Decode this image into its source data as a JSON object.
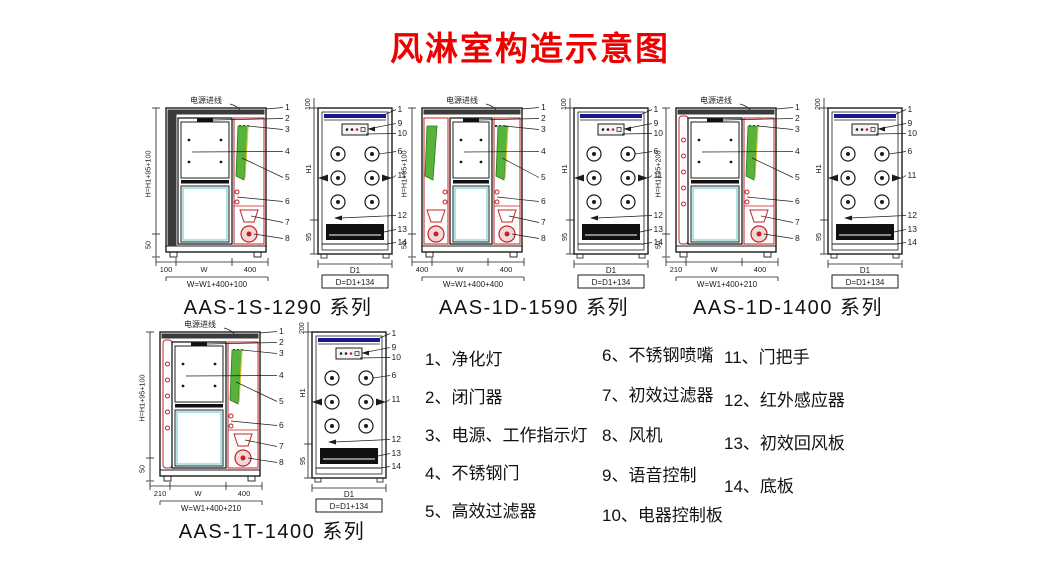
{
  "title": "风淋室构造示意图",
  "colors": {
    "title": "#ee0000",
    "line": "#1c1c1c",
    "red": "#c42222",
    "green": "#57b33a",
    "green_dark": "#2c7a1d",
    "blue": "#181890",
    "cyan": "#5fc8c8",
    "yellow": "#d9c23a",
    "dark_fill": "#3a3a3a",
    "black_fill": "#111111",
    "pink": "#f3d8d8"
  },
  "diagrams": [
    {
      "id": "aas-1s-1290",
      "series_label": "AAS-1S-1290 系列",
      "style": "single",
      "top_label": "电源进线",
      "side": {
        "height_formula": "H=H1+95+100",
        "base_height": "50",
        "bottom_dims": [
          "100",
          "W",
          "400"
        ],
        "width_formula": "W=W1+400+100",
        "callouts": [
          "1",
          "2",
          "3",
          "4",
          "5",
          "6",
          "7",
          "8"
        ]
      },
      "front": {
        "top_dim": "100",
        "height_dim": "H1",
        "bottom_section_dim": "95",
        "depth_dim": "D1",
        "depth_formula": "D=D1+134",
        "callouts": [
          "1",
          "9",
          "10",
          "6",
          "11",
          "12",
          "13",
          "14"
        ]
      }
    },
    {
      "id": "aas-1d-1590",
      "series_label": "AAS-1D-1590 系列",
      "style": "double",
      "top_label": "电源进线",
      "side": {
        "height_formula": "H=H1+95+100",
        "base_height": "50",
        "bottom_dims": [
          "400",
          "W",
          "400"
        ],
        "width_formula": "W=W1+400+400",
        "callouts": [
          "1",
          "2",
          "3",
          "4",
          "5",
          "6",
          "7",
          "8"
        ]
      },
      "front": {
        "top_dim": "100",
        "height_dim": "H1",
        "bottom_section_dim": "95",
        "depth_dim": "D1",
        "depth_formula": "D=D1+134",
        "callouts": [
          "1",
          "9",
          "10",
          "6",
          "11",
          "12",
          "13",
          "14"
        ]
      }
    },
    {
      "id": "aas-1d-1400",
      "series_label": "AAS-1D-1400 系列",
      "style": "single2",
      "top_label": "电源进线",
      "side": {
        "height_formula": "H=H1+95+200",
        "base_height": "50",
        "bottom_dims": [
          "210",
          "W",
          "400"
        ],
        "width_formula": "W=W1+400+210",
        "callouts": [
          "1",
          "2",
          "3",
          "4",
          "5",
          "6",
          "7",
          "8"
        ]
      },
      "front": {
        "top_dim": "200",
        "height_dim": "H1",
        "bottom_section_dim": "95",
        "depth_dim": "D1",
        "depth_formula": "D=D1+134",
        "callouts": [
          "1",
          "9",
          "10",
          "6",
          "11",
          "12",
          "13",
          "14"
        ]
      }
    },
    {
      "id": "aas-1t-1400",
      "series_label": "AAS-1T-1400 系列",
      "style": "single2",
      "top_label": "电源进线",
      "side": {
        "height_formula": "H=H1+95+100",
        "base_height": "50",
        "bottom_dims": [
          "210",
          "W",
          "400"
        ],
        "width_formula": "W=W1+400+210",
        "callouts": [
          "1",
          "2",
          "3",
          "4",
          "5",
          "6",
          "7",
          "8"
        ]
      },
      "front": {
        "top_dim": "200",
        "height_dim": "H1",
        "bottom_section_dim": "95",
        "depth_dim": "D1",
        "depth_formula": "D=D1+134",
        "callouts": [
          "1",
          "9",
          "10",
          "6",
          "11",
          "12",
          "13",
          "14"
        ]
      }
    }
  ],
  "legend": {
    "columns": [
      [
        "1、净化灯",
        "2、闭门器",
        "3、电源、工作指示灯",
        "4、不锈钢门",
        "5、高效过滤器"
      ],
      [
        "6、不锈钢喷嘴",
        "7、初效过滤器",
        "8、风机",
        "9、语音控制",
        "10、电器控制板"
      ],
      [
        "11、门把手",
        "12、红外感应器",
        "13、初效回风板",
        "14、底板"
      ]
    ]
  }
}
